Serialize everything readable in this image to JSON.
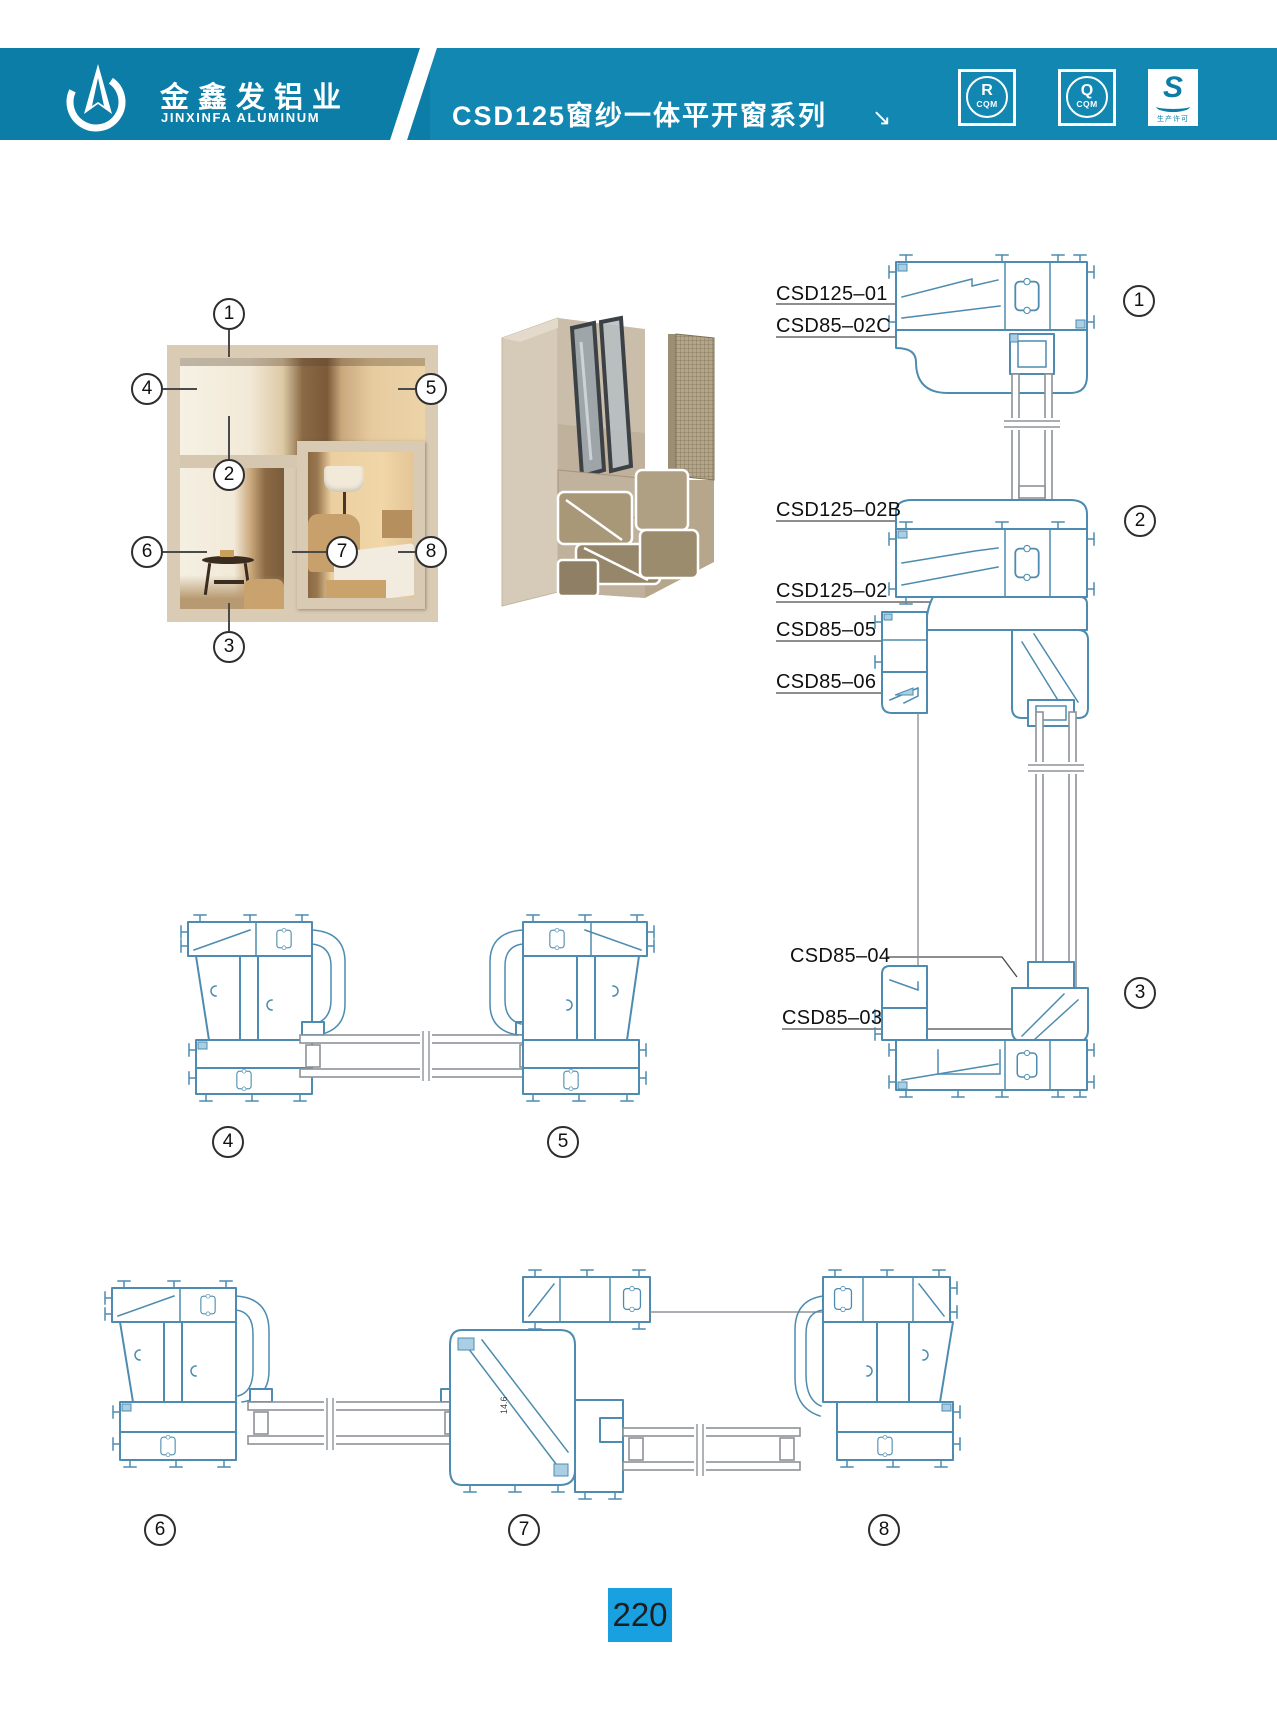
{
  "header": {
    "company_name_cn": "金鑫发铝业",
    "company_name_en": "JINXINFA ALUMINUM",
    "series_title": "CSD125窗纱一体平开窗系列",
    "title_arrow": "↘",
    "badges": [
      {
        "symbol": "R",
        "caption": "CQM"
      },
      {
        "symbol": "Q",
        "caption": "CQM"
      },
      {
        "symbol": "S",
        "caption": "生产许可"
      }
    ]
  },
  "callout_numbers": [
    "1",
    "2",
    "3",
    "4",
    "5",
    "6",
    "7",
    "8"
  ],
  "part_labels": [
    "CSD125–01",
    "CSD85–02C",
    "CSD125–02B",
    "CSD125–02",
    "CSD85–05",
    "CSD85–06",
    "CSD85–04",
    "CSD85–03"
  ],
  "dimension_note": "14.6",
  "page_number": "220",
  "colors": {
    "header_teal": "#0b7da7",
    "header_teal_light": "#1187b2",
    "page_number_blue": "#18a0e0",
    "drawing_stroke_blue": "#4d8cb0",
    "drawing_accent_blue": "#aacfe4"
  }
}
